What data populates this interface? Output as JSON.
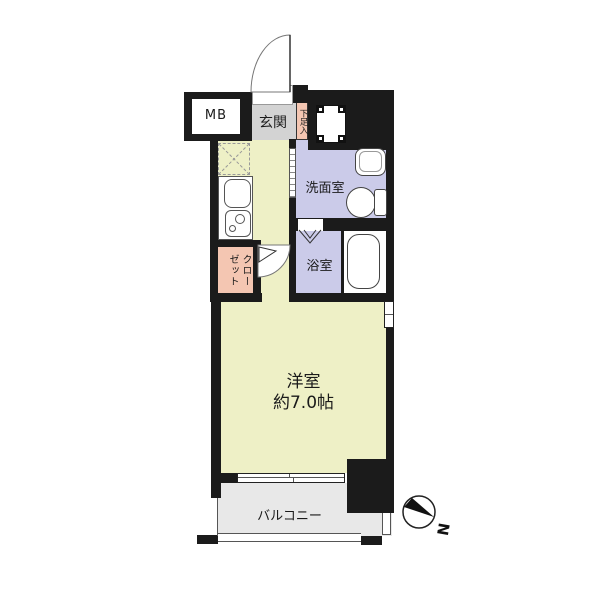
{
  "floorplan": {
    "rooms": {
      "meter_box": "MB",
      "entrance": "玄関",
      "shoe_box": "下足入",
      "washroom": "洗面室",
      "bathroom": "浴室",
      "closet": "クローゼット",
      "western_room_name": "洋室",
      "western_room_size": "約7.0帖",
      "balcony": "バルコニー"
    },
    "compass": {
      "north_label": "N"
    },
    "colors": {
      "wall": "#1b1b1b",
      "living_floor": "#eef0c6",
      "wet_area": "#cbcbe9",
      "closet": "#f4c6b2",
      "entrance": "#d3d3d3",
      "balcony": "#e8e8e8"
    }
  }
}
